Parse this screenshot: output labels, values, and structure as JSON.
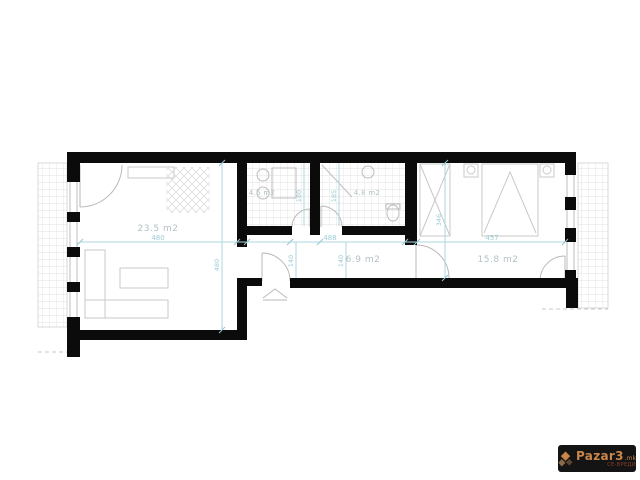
{
  "plan": {
    "labels": {
      "living": "23.5 m2",
      "kitchen": "4.5 m2",
      "bathroom": "4.8 m2",
      "hallway": "6.9 m2",
      "bedroom": "15.8 m2"
    },
    "dims": {
      "living_w": "480",
      "living_h": "480",
      "hallway_w": "488",
      "hallway_h_a": "140",
      "hallway_h_b": "140",
      "kitchen_h": "180",
      "bathroom_h": "185",
      "bedroom_w": "457",
      "bedroom_h": "346"
    },
    "colors": {
      "wall": "#0b0b0b",
      "dimension": "#aed7df",
      "label": "#b3c2c6",
      "tile": "#d8d8d8"
    }
  },
  "watermark": {
    "brand": "Pazar3",
    "tld": ".mk",
    "tagline": "СЕ-ВРЕДИ"
  }
}
